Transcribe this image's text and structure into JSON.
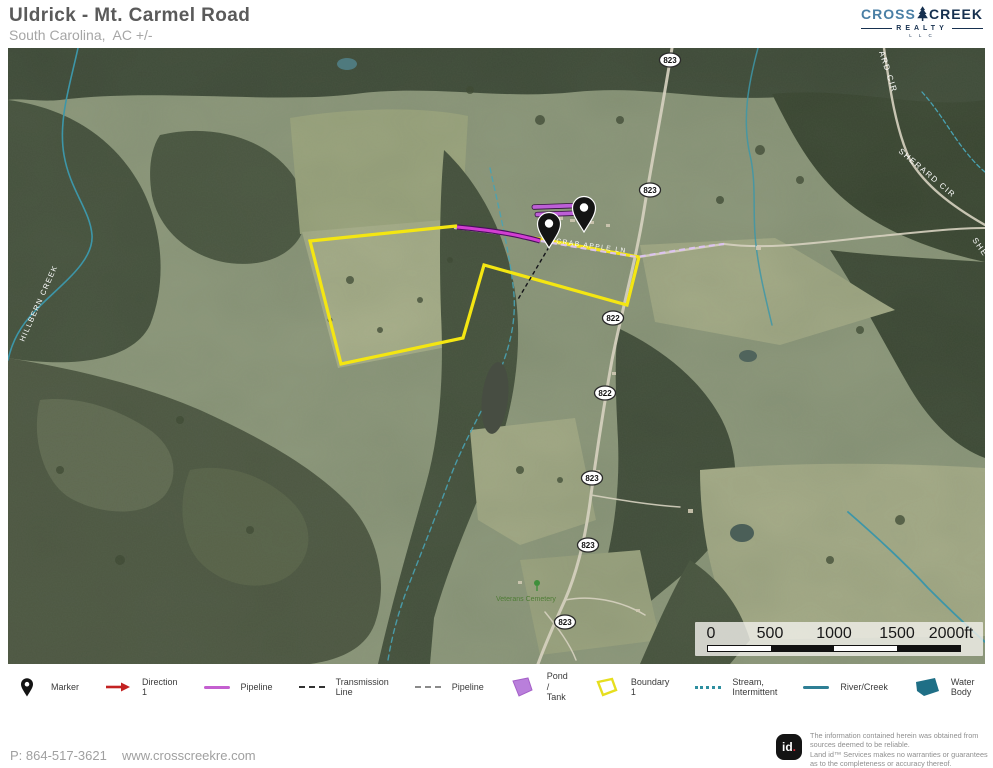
{
  "header": {
    "title": "Uldrick - Mt. Carmel Road",
    "subtitle": "South Carolina,  AC +/-"
  },
  "logo": {
    "cross": "CROSS",
    "creek": "CREEK",
    "realty": "REALTY",
    "llc": "L L C"
  },
  "map": {
    "shields": [
      {
        "label": "823"
      },
      {
        "label": "823"
      },
      {
        "label": "822"
      },
      {
        "label": "822"
      },
      {
        "label": "823"
      },
      {
        "label": "823"
      },
      {
        "label": "823"
      }
    ],
    "labels": {
      "creek": "HILLBERN CREEK",
      "road": "CRAB APPLE LN",
      "sherard": "SHERARD CIR",
      "sherard_top": "ARD CIR",
      "sherard_edge": "SHE",
      "cemetery": "Veterans Cemetery"
    },
    "scale": {
      "ticks": [
        "0",
        "500",
        "1000",
        "1500",
        "2000ft"
      ]
    }
  },
  "legend": {
    "items": [
      {
        "label": "Marker",
        "icon": "marker-pin"
      },
      {
        "label": "Direction 1",
        "icon": "red-arrow"
      },
      {
        "label": "Pipeline",
        "icon": "purple-line"
      },
      {
        "label": "Transmission Line",
        "icon": "black-dashed-line"
      },
      {
        "label": "Pipeline",
        "icon": "gray-dashed-line"
      },
      {
        "label": "Pond / Tank",
        "icon": "purple-polygon"
      },
      {
        "label": "Boundary 1",
        "icon": "yellow-polygon"
      },
      {
        "label": "Stream, Intermittent",
        "icon": "teal-dashed-line"
      },
      {
        "label": "River/Creek",
        "icon": "teal-line"
      },
      {
        "label": "Water Body",
        "icon": "teal-polygon"
      }
    ]
  },
  "footer": {
    "phone": "P: 864-517-3621",
    "website": "www.crosscreekre.com",
    "id_logo_text": "id",
    "id_logo_dot": ".",
    "disclaimer": [
      "The information contained herein was obtained from",
      "sources deemed to be reliable.",
      " Land id™  Services makes no warranties or guarantees",
      "as to the completeness or accuracy thereof."
    ]
  },
  "colors": {
    "boundary_yellow": "#f4e612",
    "pipeline_magenta": "#d23ed2",
    "pond_tank_purple": "#bd5fd6",
    "water_teal": "#2e7f95",
    "direction_red": "#c32222",
    "logo_navy": "#16304f",
    "logo_blue": "#4a7fa5",
    "id_dot_red": "#d92b3a"
  }
}
